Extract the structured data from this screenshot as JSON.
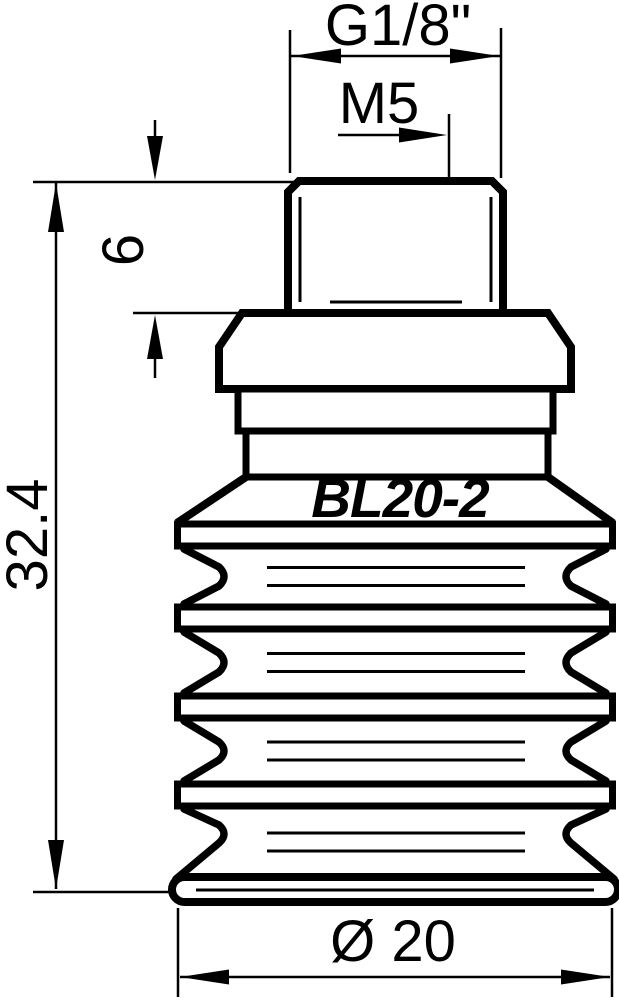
{
  "drawing": {
    "background": "#ffffff",
    "line_color": "#000000",
    "part_marking": "BL20-2",
    "dimensions": {
      "thread": "G1/8\"",
      "vacuum_port_thread": "M5",
      "thread_length": "6",
      "overall_height": "32.4",
      "diameter": "Ø 20"
    }
  }
}
